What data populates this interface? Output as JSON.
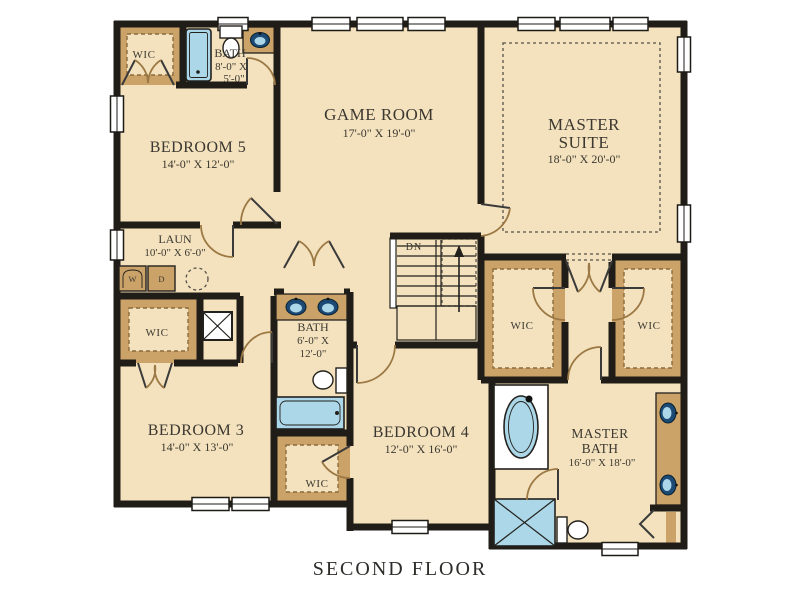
{
  "caption": {
    "title": "SECOND FLOOR"
  },
  "rooms": {
    "wic_top_left": {
      "label": "WIC"
    },
    "bath_top": {
      "label": "BATH",
      "dim1": "8'-0\" X",
      "dim2": "5'-0\""
    },
    "bedroom5": {
      "label": "BEDROOM 5",
      "dims": "14'-0\" X 12'-0\""
    },
    "game_room": {
      "label": "GAME ROOM",
      "dims": "17'-0\" X 19'-0\""
    },
    "master_suite": {
      "label1": "MASTER",
      "label2": "SUITE",
      "dims": "18'-0\" X 20'-0\""
    },
    "laundry": {
      "label": "LAUN",
      "dims": "10'-0\" X 6'-0\"",
      "washer": "W",
      "dryer": "D"
    },
    "wic_bedroom3": {
      "label": "WIC"
    },
    "bath_middle": {
      "label": "BATH",
      "dim1": "6'-0\" X",
      "dim2": "12'-0\""
    },
    "stairs": {
      "label": "DN"
    },
    "wic_master_left": {
      "label": "WIC"
    },
    "wic_master_right": {
      "label": "WIC"
    },
    "bedroom3": {
      "label": "BEDROOM 3",
      "dims": "14'-0\" X 13'-0\""
    },
    "wic_bedroom4": {
      "label": "WIC"
    },
    "bedroom4": {
      "label": "BEDROOM 4",
      "dims": "12'-0\" X 16'-0\""
    },
    "master_bath": {
      "label1": "MASTER",
      "label2": "BATH",
      "dims": "16'-0\" X 18'-0\""
    }
  },
  "colors": {
    "floor": "#F3E2BD",
    "wall": "#201d18",
    "tan": "#CBA369",
    "tanDark": "#8a6b3e",
    "blue": "#ABD7E8",
    "navy": "#1c4a74",
    "text": "#3c3831",
    "dash": "#55504a",
    "arc": "#9c7844"
  }
}
